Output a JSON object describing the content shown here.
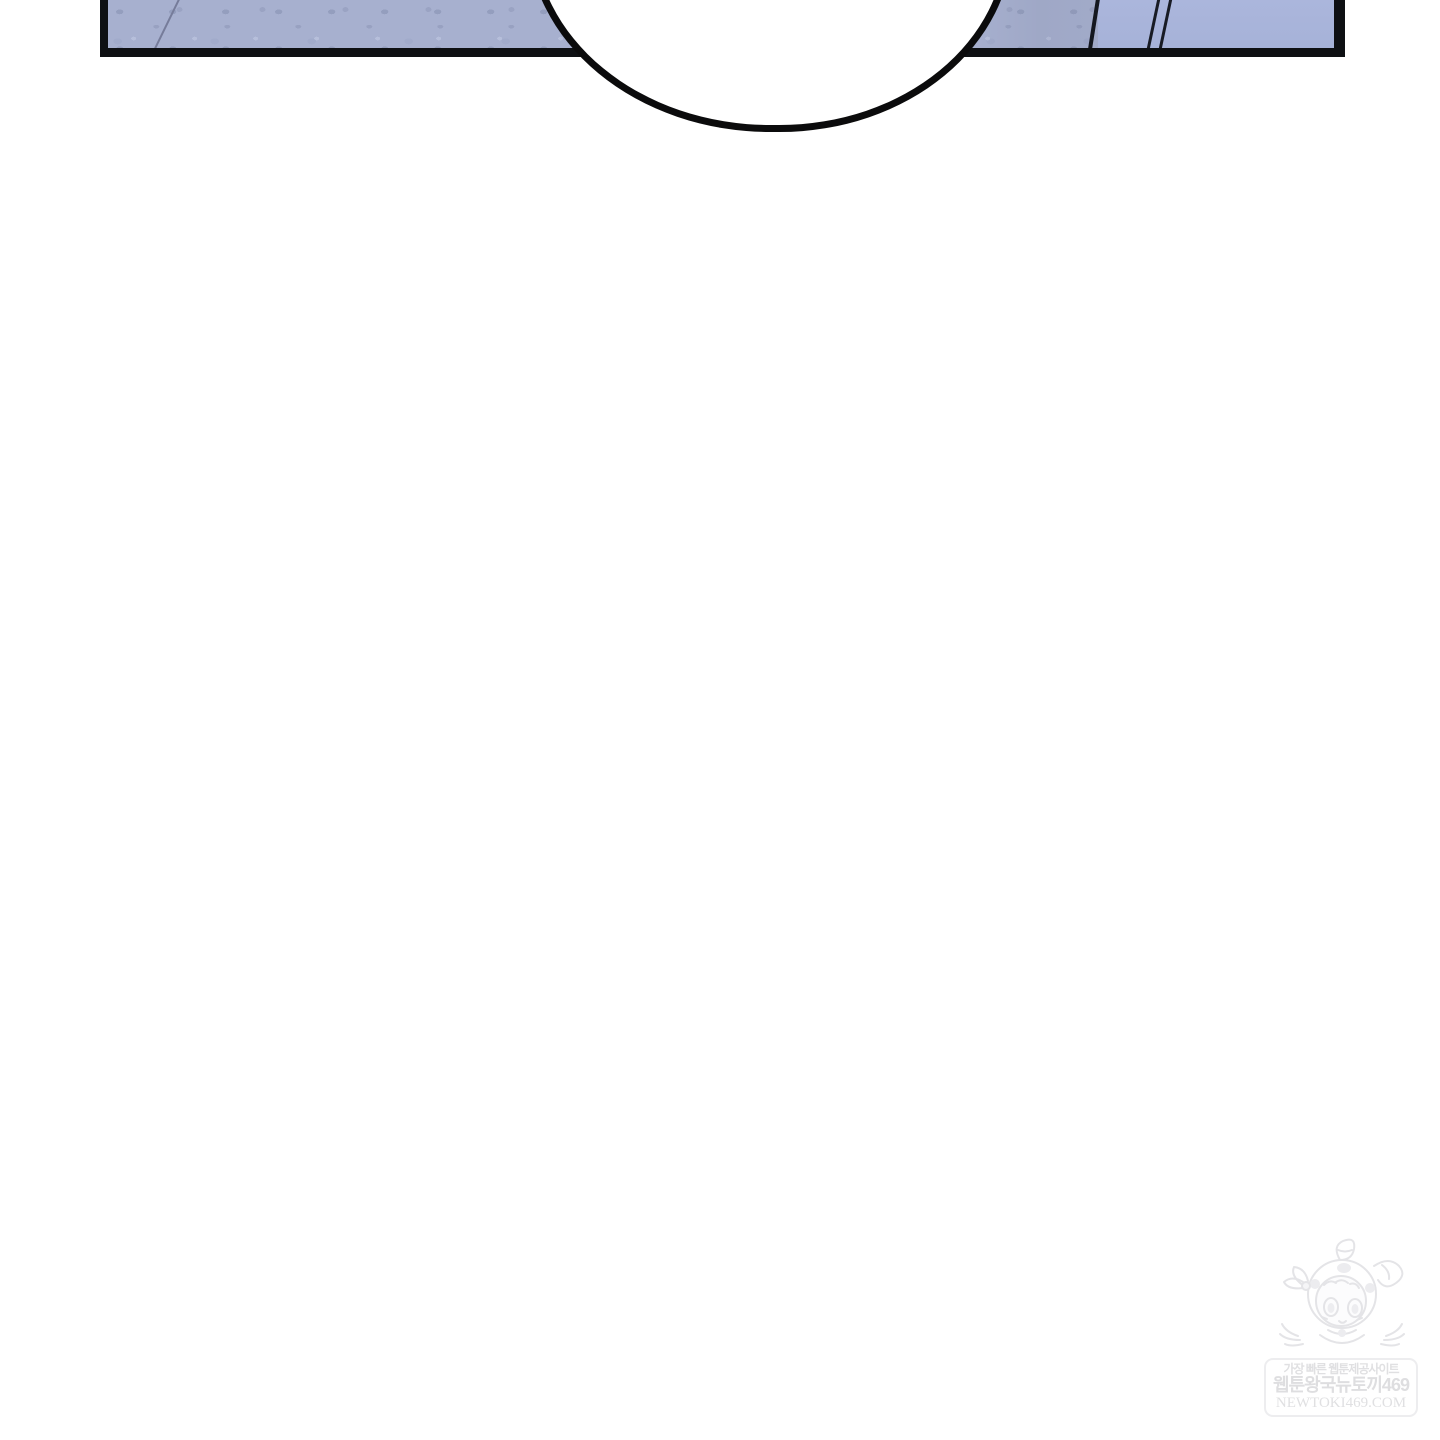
{
  "page": {
    "background_color": "#ffffff",
    "kind": "webtoon comic page segment"
  },
  "panel": {
    "description": "cropped top panel showing a blue wall interior",
    "border_color": "#0e1013",
    "wall_base_color": "#a7b0cf",
    "wall_right_color": "#aab5db",
    "wall_texture_color": "#97a1c3",
    "detail_line_color": "#14171f"
  },
  "speech_bubble": {
    "text": "",
    "fill_color": "#ffffff",
    "stroke_color": "#0b0b0c"
  },
  "watermark": {
    "tagline": "가장 빠른 웹툰제공사이트",
    "site_name": "웹툰왕국뉴토끼469",
    "domain": "NEWTOKI469.COM",
    "ink_color": "#e0e0e2",
    "mascot": "bunny-hood-girl"
  }
}
